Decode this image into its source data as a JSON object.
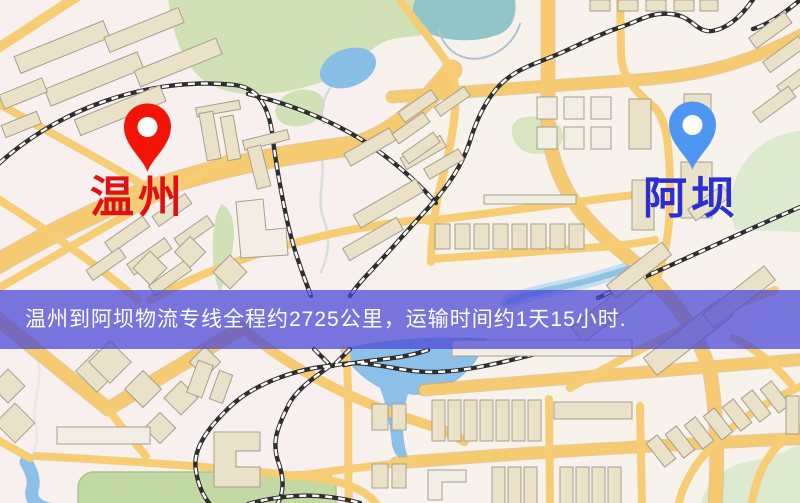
{
  "map": {
    "title": "温州到阿坝物流专线地图",
    "origin": {
      "label": "温州",
      "label_color": "#e21111",
      "pin_color": "#f21507"
    },
    "destination": {
      "label": "阿坝",
      "label_color": "#2b2fd0",
      "pin_color": "#4f95f2"
    },
    "banner": {
      "text": "温州到阿坝物流专线全程约2725公里，运输时间约1天15小时.",
      "background": "rgba(72,70,214,0.73)",
      "text_color": "#ffffff"
    },
    "route": {
      "origin": "温州",
      "destination": "阿坝",
      "distance_text": "约2725公里",
      "duration_text": "约1天15小时"
    },
    "palette": {
      "map_background": "#f7f0ee",
      "road": "#f5ca70",
      "road_casing": "#e3aa4a",
      "building": "#e9e1c8",
      "park_green": "#cfe1b5",
      "water_blue": "#8cc0e8",
      "pond_teal": "#92c5c7",
      "railway": "#2e2e2e"
    }
  }
}
